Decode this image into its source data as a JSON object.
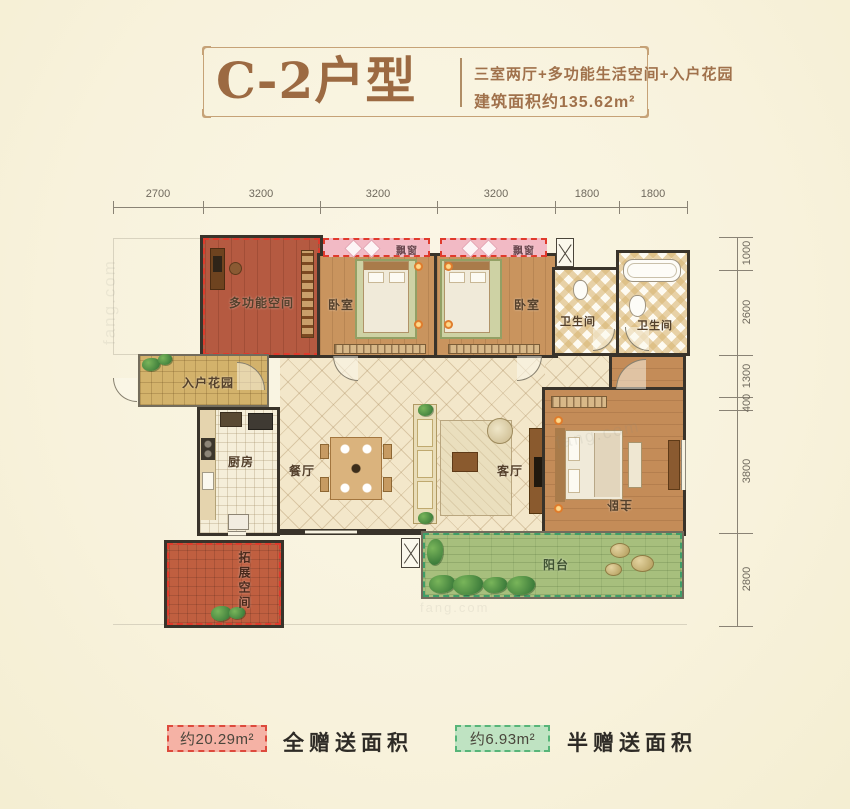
{
  "header": {
    "title": "C-2户型",
    "subtitle_line1": "三室两厅+多功能生活空间+入户花园",
    "subtitle_line2": "建筑面积约135.62m²"
  },
  "dimensions": {
    "top": [
      "2700",
      "3200",
      "3200",
      "3200",
      "1800",
      "1800"
    ],
    "right": [
      "1000",
      "2600",
      "1300",
      "400",
      "3800",
      "2800"
    ]
  },
  "rooms": {
    "multi_function_room": "多功能空间",
    "bedroom_left": "卧室",
    "bedroom_right": "卧室",
    "bay_window_left": "飘窗",
    "bay_window_right": "飘窗",
    "bathroom_left": "卫生间",
    "bathroom_right": "卫生间",
    "entry_garden": "入户花园",
    "kitchen": "厨房",
    "dining_room": "餐厅",
    "living_room": "客厅",
    "master_bedroom": "主卧",
    "balcony": "阳台",
    "expansion_space": "拓展空间"
  },
  "legend": {
    "full_gift_area": "约20.29m²",
    "full_gift_label": "全赠送面积",
    "half_gift_area": "约6.93m²",
    "half_gift_label": "半赠送面积"
  },
  "colors": {
    "title_brown": "#9c6a42",
    "full_gift_fill": "#f5b2a5",
    "full_gift_border": "#dd4a3c",
    "half_gift_fill": "#bfe3c2",
    "half_gift_border": "#57b578",
    "wall": "#39332a"
  },
  "watermark_text": "fang.com"
}
